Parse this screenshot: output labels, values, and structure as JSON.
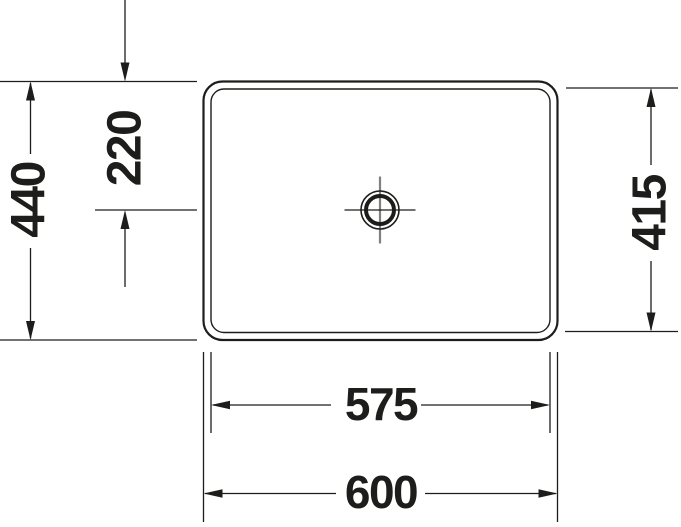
{
  "colors": {
    "line": "#1d1d1b",
    "centerline": "#808080",
    "text": "#1d1d1b",
    "background": "#ffffff"
  },
  "dimensions": {
    "width_overall": "600",
    "width_inner": "575",
    "depth_overall": "440",
    "depth_inner": "415",
    "drain_offset": "220"
  }
}
